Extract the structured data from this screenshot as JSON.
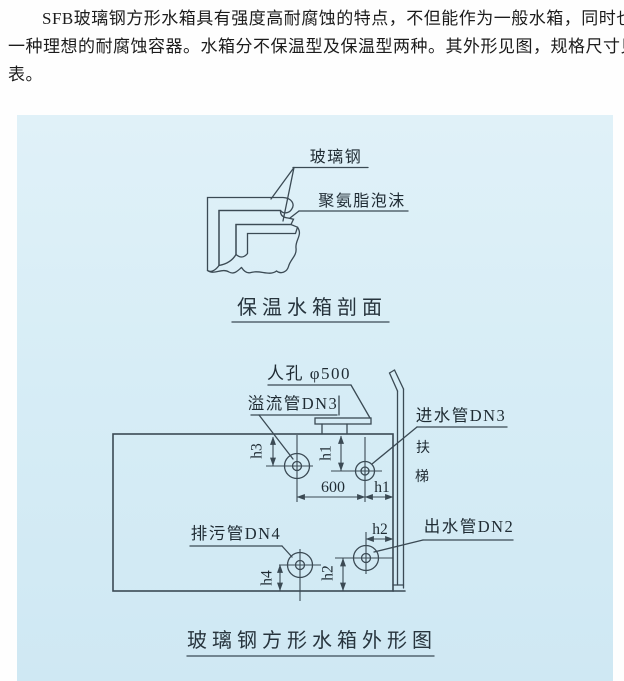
{
  "intro": {
    "lines": [
      "SFB玻璃钢方形水箱具有强度高耐腐蚀的特点，不但能作为一般水箱，同时也是",
      "一种理想的耐腐蚀容器。水箱分不保温型及保温型两种。其外形见图，规格尺寸见",
      "表。"
    ]
  },
  "section_diagram": {
    "label_fiberglass": "玻璃钢",
    "label_foam": "聚氨脂泡沫",
    "caption": "保温水箱剖面"
  },
  "outline_diagram": {
    "label_manhole": "人孔 φ500",
    "label_overflow": "溢流管DN3",
    "label_inlet": "进水管DN3",
    "label_ladder_char1": "扶",
    "label_ladder_char2": "梯",
    "label_drain": "排污管DN4",
    "label_outlet": "出水管DN2",
    "caption": "玻璃钢方形水箱外形图"
  },
  "dims": {
    "d600": "600",
    "h1": "h1",
    "h2": "h2",
    "h3": "h3",
    "h4": "h4"
  },
  "colors": {
    "panel_background": "#d7edf6",
    "line_color": "#3b4a54",
    "text_color": "#1f2b33"
  }
}
